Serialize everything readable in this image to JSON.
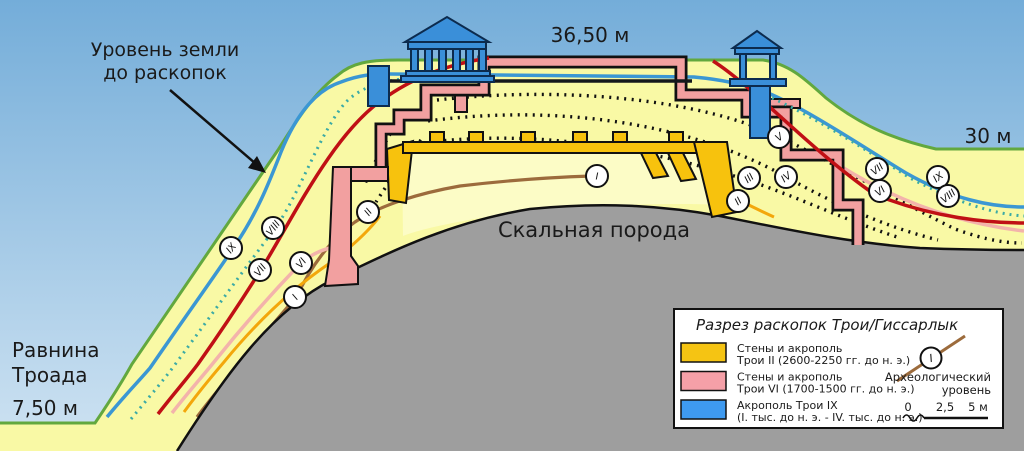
{
  "annotations": {
    "ground_level_line1": "Уровень земли",
    "ground_level_line2": "до раскопок",
    "summit_elevation": "36,50 м",
    "right_elevation": "30 м",
    "bedrock_label": "Скальная порода",
    "plain_line1": "Равнина",
    "plain_line2": "Троада",
    "plain_elevation": "7,50 м"
  },
  "legend": {
    "title": "Разрез раскопок Трои/Гиссарлык",
    "items": [
      {
        "color": "#F5C413",
        "line1": "Стены и акрополь",
        "line2": "Трои II (2600-2250 гг. до н. э.)"
      },
      {
        "color": "#F5A0A8",
        "line1": "Стены и акрополь",
        "line2": "Трои VI (1700-1500 гг. до н. э.)"
      },
      {
        "color": "#3E9AF0",
        "line1": "Акрополь Трои IX",
        "line2": "(I. тыс. до н. э. - IV. тыс. до н. э.)"
      }
    ],
    "arch_level_line1": "Археологический",
    "arch_level_line2": "уровень",
    "arch_level_symbol": "I",
    "scale_ticks": [
      "0",
      "2,5",
      "5 м"
    ]
  },
  "markers": [
    {
      "label": "I",
      "x": 597,
      "y": 176,
      "rot": 0
    },
    {
      "label": "IX",
      "x": 231,
      "y": 248,
      "rot": -52
    },
    {
      "label": "VIII",
      "x": 273,
      "y": 228,
      "rot": -52
    },
    {
      "label": "VII",
      "x": 260,
      "y": 270,
      "rot": -52
    },
    {
      "label": "VI",
      "x": 301,
      "y": 263,
      "rot": -52
    },
    {
      "label": "II",
      "x": 368,
      "y": 212,
      "rot": -52
    },
    {
      "label": "I",
      "x": 295,
      "y": 297,
      "rot": -52
    },
    {
      "label": "V",
      "x": 779,
      "y": 137,
      "rot": -38
    },
    {
      "label": "IV",
      "x": 786,
      "y": 177,
      "rot": -38
    },
    {
      "label": "III",
      "x": 749,
      "y": 178,
      "rot": -38
    },
    {
      "label": "II",
      "x": 738,
      "y": 201,
      "rot": -38
    },
    {
      "label": "VII",
      "x": 877,
      "y": 169,
      "rot": -38
    },
    {
      "label": "VI",
      "x": 880,
      "y": 191,
      "rot": -38
    },
    {
      "label": "IX",
      "x": 938,
      "y": 177,
      "rot": -38
    },
    {
      "label": "VIII",
      "x": 948,
      "y": 196,
      "rot": -38
    }
  ],
  "colors": {
    "sky_top": "#74ADD9",
    "sky_bottom": "#CFE3F2",
    "hill": "#F9F9A5",
    "hill_inner": "#FCFCC6",
    "bedrock": "#9E9E9E",
    "surface_green": "#62A83E",
    "level_I_brown": "#9C6B3C",
    "level_II_orange": "#F3A70B",
    "level_VI_pink": "#F3B3AB",
    "level_VII_red": "#C01015",
    "level_VIII_teal": "#3BAAA5",
    "level_IX_blue": "#3B97D3",
    "troy2_wall": "#F7C20D",
    "troy6_wall": "#F2A0A0",
    "troy9_blue": "#3A8FD9"
  }
}
